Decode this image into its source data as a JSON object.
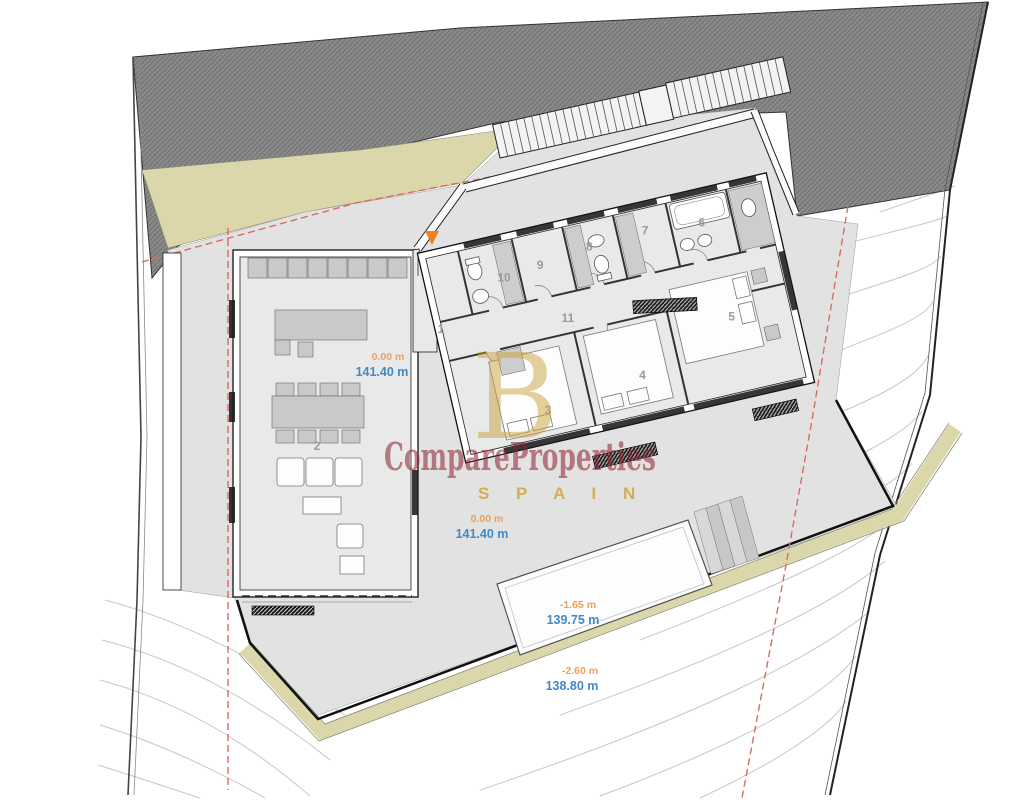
{
  "title": "Villa site and floor plan",
  "watermark": {
    "monogram": "B",
    "brand": "CompareProperties",
    "country": "S P A I N",
    "brand_color": "#8d1f2d",
    "gold_color": "#d1a63e"
  },
  "rooms": [
    {
      "number": "1"
    },
    {
      "number": "2"
    },
    {
      "number": "3"
    },
    {
      "number": "4"
    },
    {
      "number": "5"
    },
    {
      "number": "6"
    },
    {
      "number": "7"
    },
    {
      "number": "8"
    },
    {
      "number": "9"
    },
    {
      "number": "10"
    },
    {
      "number": "11"
    }
  ],
  "levels": {
    "house": {
      "rel": "0.00 m",
      "abs": "141.40 m"
    },
    "terrace": {
      "rel": "0.00 m",
      "abs": "141.40 m"
    },
    "pool": {
      "rel": "-1.65 m",
      "abs": "139.75 m"
    },
    "lower": {
      "rel": "-2.60 m",
      "abs": "138.80 m"
    }
  },
  "colors": {
    "plot_gray": "#e2e2e2",
    "terrain_dark": "#8a8a8a",
    "khaki": "#dbd7ab",
    "setback_red": "#d96b62",
    "level_orange": "#efa05e",
    "level_blue": "#4189c9",
    "entrance_orange": "#e8831f"
  }
}
